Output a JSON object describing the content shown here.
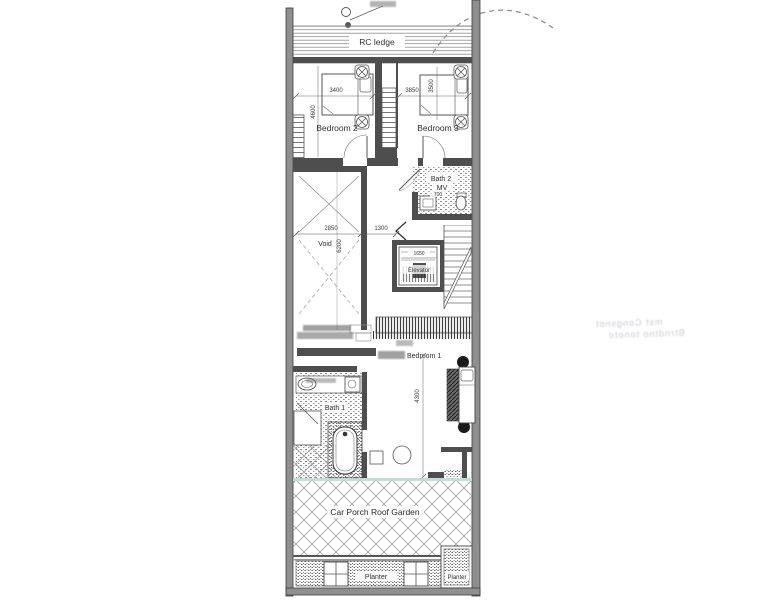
{
  "colors": {
    "ink": "#3a3a3a",
    "wall_fill": "#4e4e4e",
    "party_wall_fill": "#8f8f8f",
    "hatch_gray": "#9a9a9a",
    "teal_divider": "#b9dbd7",
    "paper": "#ffffff"
  },
  "labels": {
    "rc_ledge": "RC ledge",
    "bedroom2": "Bedroom 2",
    "bedroom3": "Bedroom 3",
    "bath2": "Bath 2",
    "mv": "MV",
    "void": "Void",
    "elevator": "Elevator",
    "bedroom1": "Bedroom 1",
    "bath1": "Bath 1",
    "car_porch_roof_garden": "Car Porch Roof Garden",
    "planter": "Planter",
    "planter_right": "Planter"
  },
  "dimension_texts": {
    "bedroom2_width": "3400",
    "bedroom2_depth": "4600",
    "bedroom3_width": "3850",
    "bedroom3_depth": "3500",
    "void_width": "2850",
    "void_depth": "6200",
    "landing_width": "1300",
    "elevator_width": "1650",
    "bath2_fixture": "700",
    "bedroom1_depth": "4300"
  },
  "scan_artifacts": {
    "bleed_note_line1": "mst Congsnot",
    "bleed_note_line2": "Btrndtno tonoto"
  }
}
